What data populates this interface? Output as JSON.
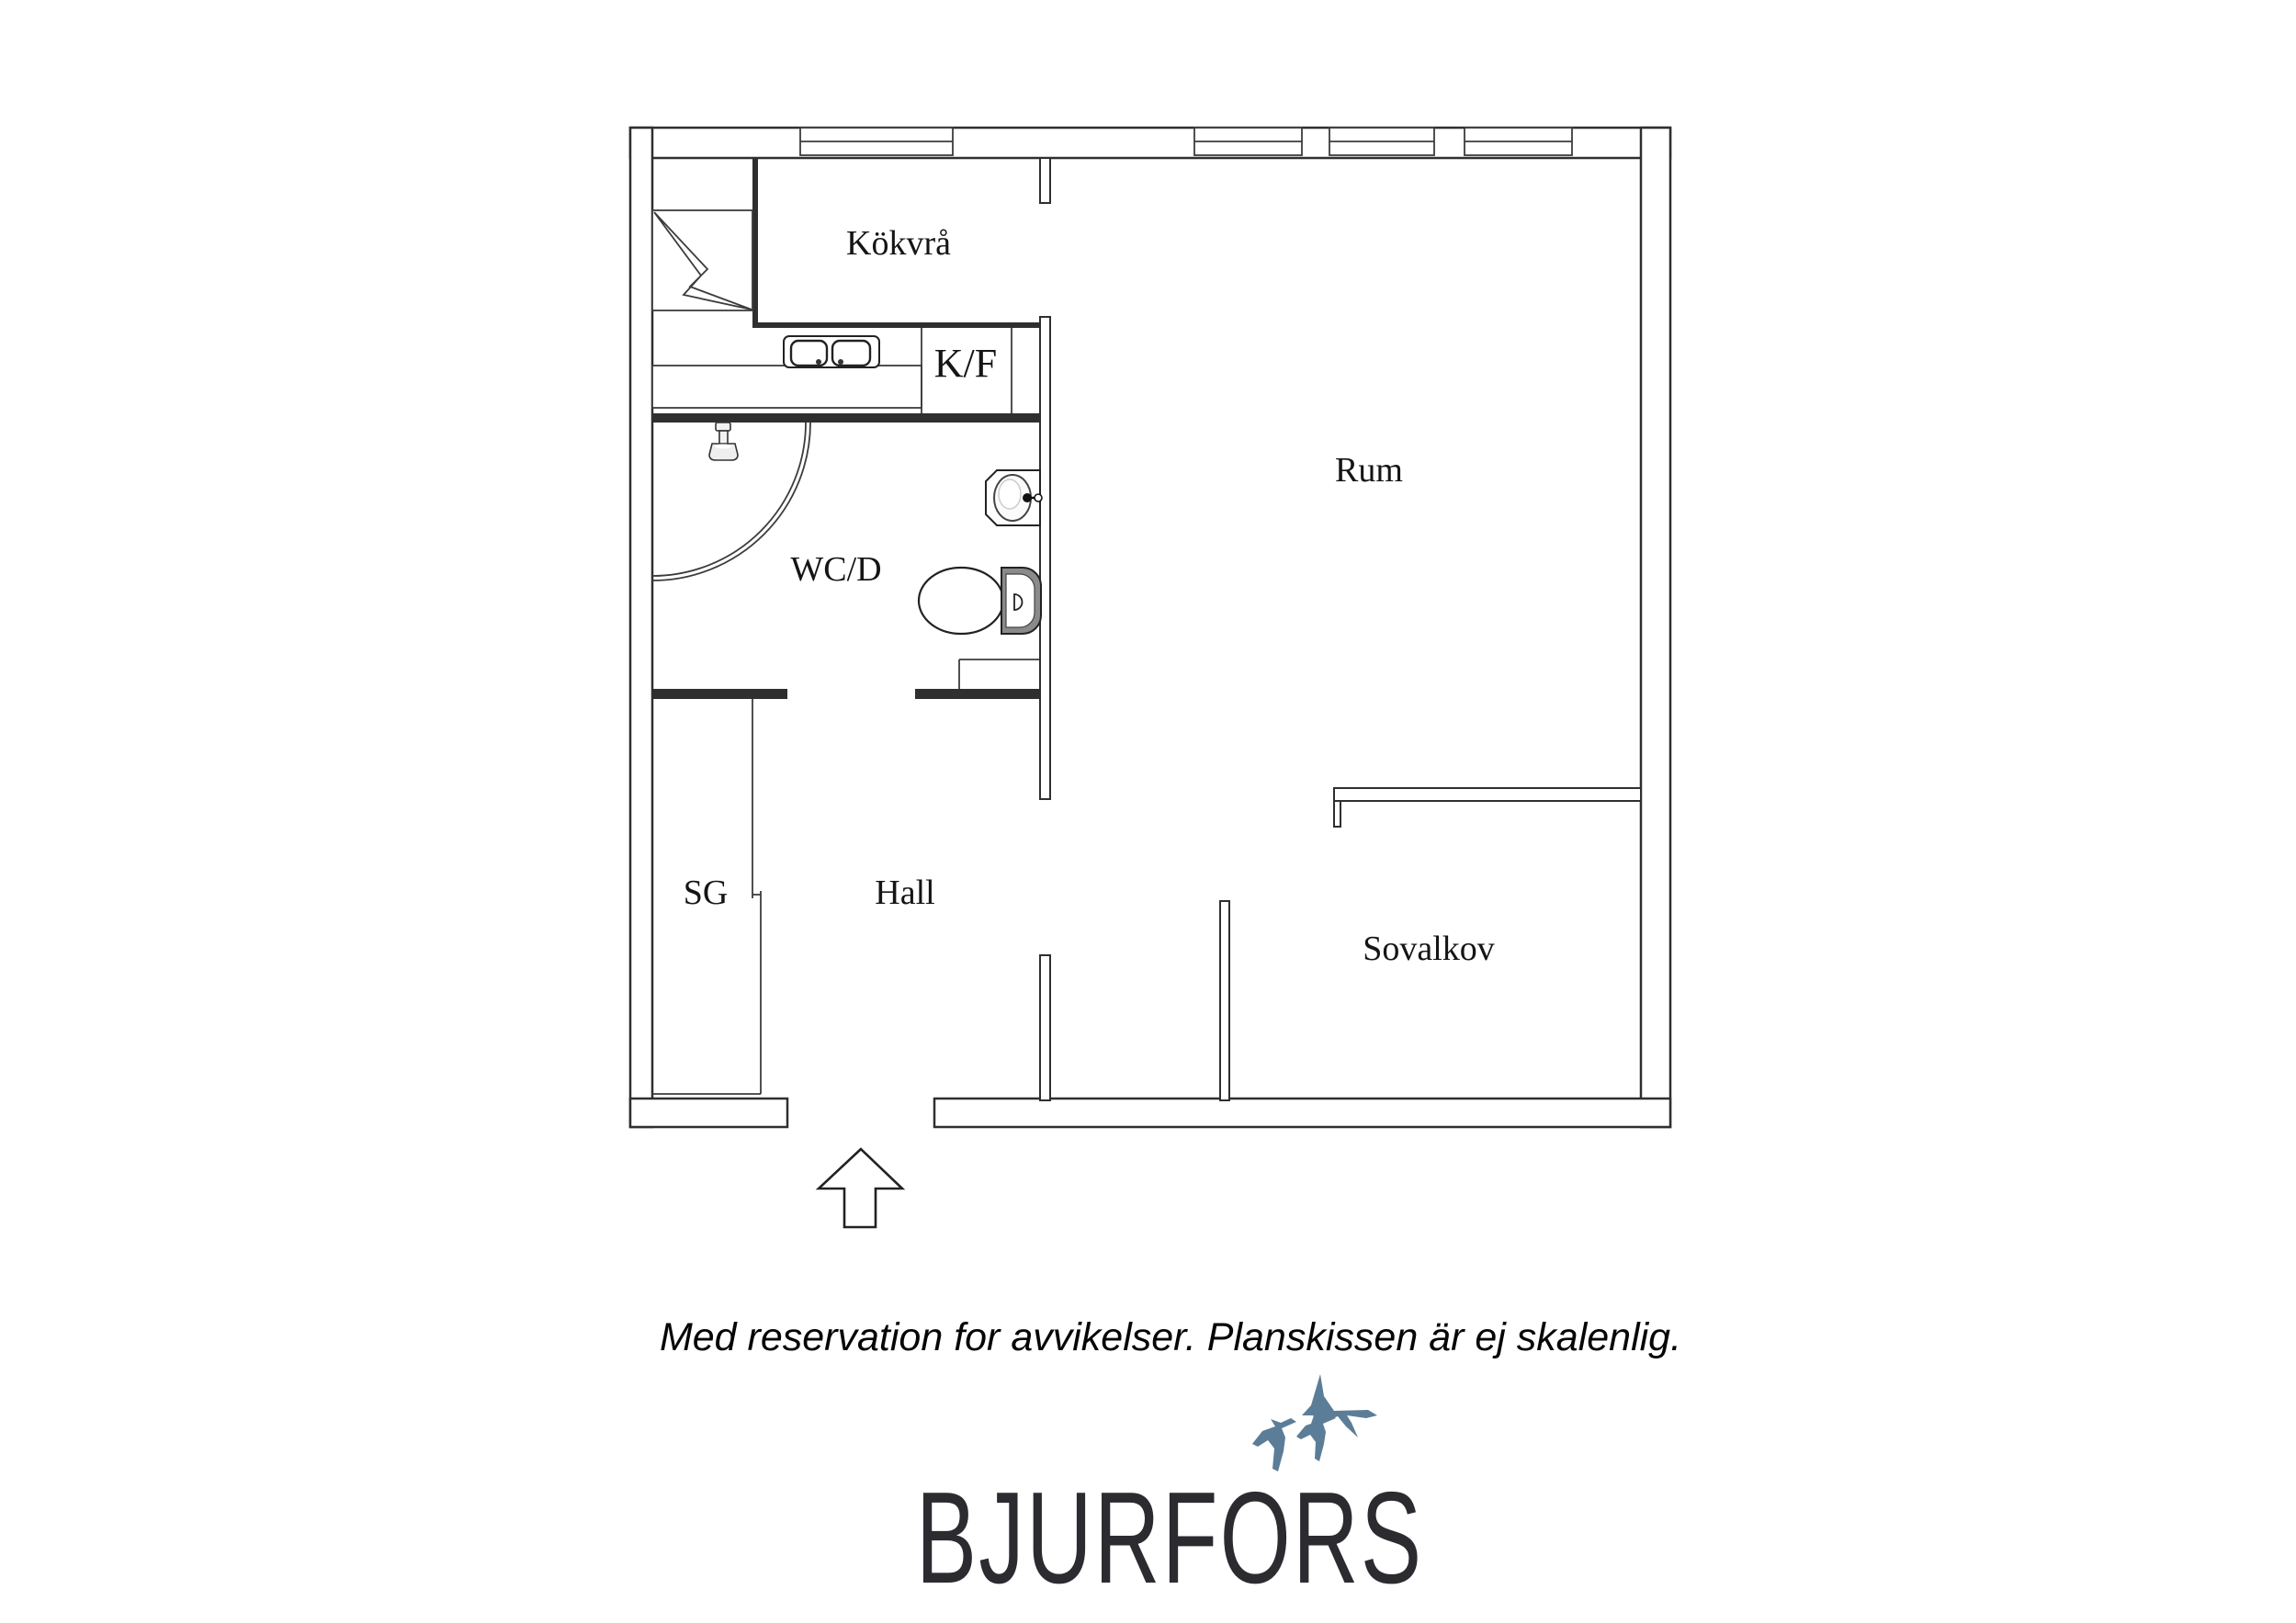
{
  "floorplan": {
    "rooms": [
      {
        "id": "kokvra",
        "label": "Kökvrå"
      },
      {
        "id": "kf",
        "label": "K/F"
      },
      {
        "id": "rum",
        "label": "Rum"
      },
      {
        "id": "wcd",
        "label": "WC/D"
      },
      {
        "id": "sg",
        "label": "SG"
      },
      {
        "id": "hall",
        "label": "Hall"
      },
      {
        "id": "sovalkov",
        "label": "Sovalkov"
      }
    ],
    "symbols": [
      "stove-icon",
      "kitchen-sink-icon",
      "shower-icon",
      "washbasin-icon",
      "toilet-icon",
      "entrance-arrow-icon",
      "window"
    ]
  },
  "disclaimer": "Med reservation for avvikelser. Planskissen är ej skalenlig.",
  "logo": {
    "brand": "BJURFORS",
    "text_color": "#2b2b30",
    "birds_color": "#5b7d98"
  },
  "colors": {
    "background": "#ffffff",
    "wall_line": "#2f2f2f",
    "label": "#151515"
  }
}
